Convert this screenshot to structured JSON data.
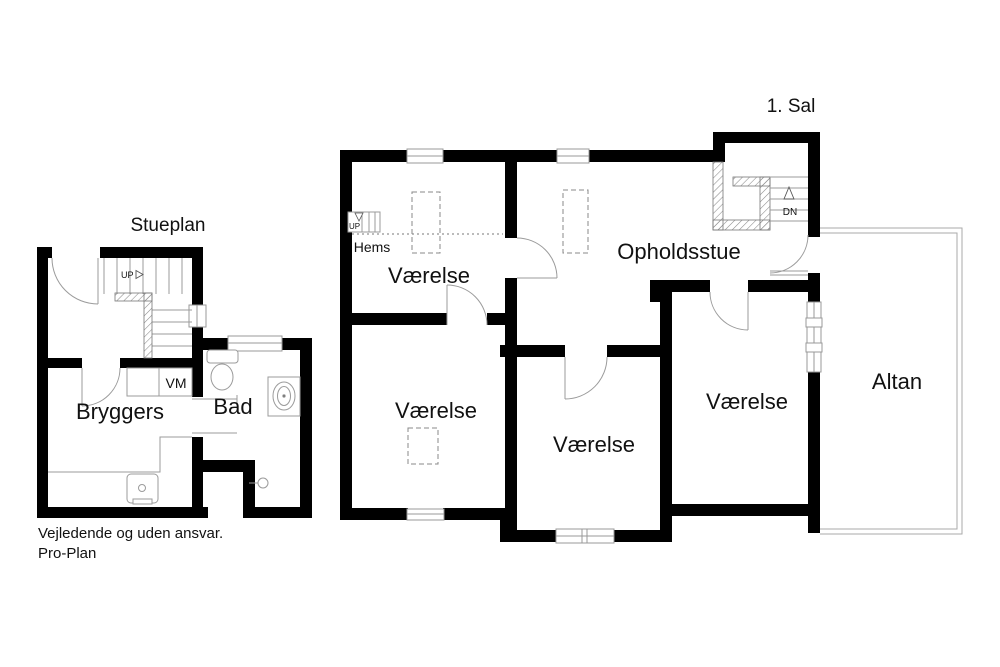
{
  "document": {
    "footer_line1": "Vejledende og uden ansvar.",
    "footer_line2": "Pro-Plan"
  },
  "ground_floor": {
    "title": "Stueplan",
    "rooms": {
      "bryggers": "Bryggers",
      "bad": "Bad"
    },
    "appliances": {
      "washing_machine": "VM"
    },
    "stairs": {
      "up": "UP"
    }
  },
  "first_floor": {
    "title": "1. Sal",
    "rooms": {
      "hems": "Hems",
      "vaerelse_top_left": "Værelse",
      "opholdsstue": "Opholdsstue",
      "vaerelse_bottom_left": "Værelse",
      "vaerelse_bottom_middle": "Værelse",
      "vaerelse_right": "Værelse",
      "altan": "Altan"
    },
    "stairs": {
      "up": "UP",
      "dn": "DN"
    }
  },
  "colors": {
    "wall": "#000000",
    "fixture_line": "#9b9b9b",
    "text": "#111111",
    "background": "#ffffff"
  }
}
